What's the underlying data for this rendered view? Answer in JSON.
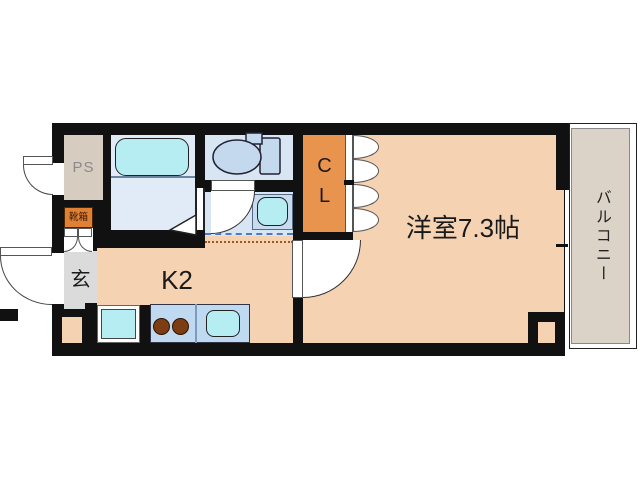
{
  "floorplan": {
    "rooms": {
      "main_room": "洋室7.3帖",
      "kitchen": "K2",
      "closet": "CL",
      "pipe_space": "PS",
      "entrance": "玄",
      "shoe_box": "靴箱",
      "balcony": "バルコニー"
    },
    "colors": {
      "wall": "#111111",
      "floor": "#F4D2B2",
      "wet_area": "#D8E6F4",
      "fixture": "#B5EDF3",
      "counter": "#BFD9F0",
      "closet": "#E8934E",
      "shoe_box": "#E08034",
      "pipe_space": "#D7CCC0",
      "entrance": "#DBDBDB",
      "balcony": "#DBD3C8"
    }
  }
}
